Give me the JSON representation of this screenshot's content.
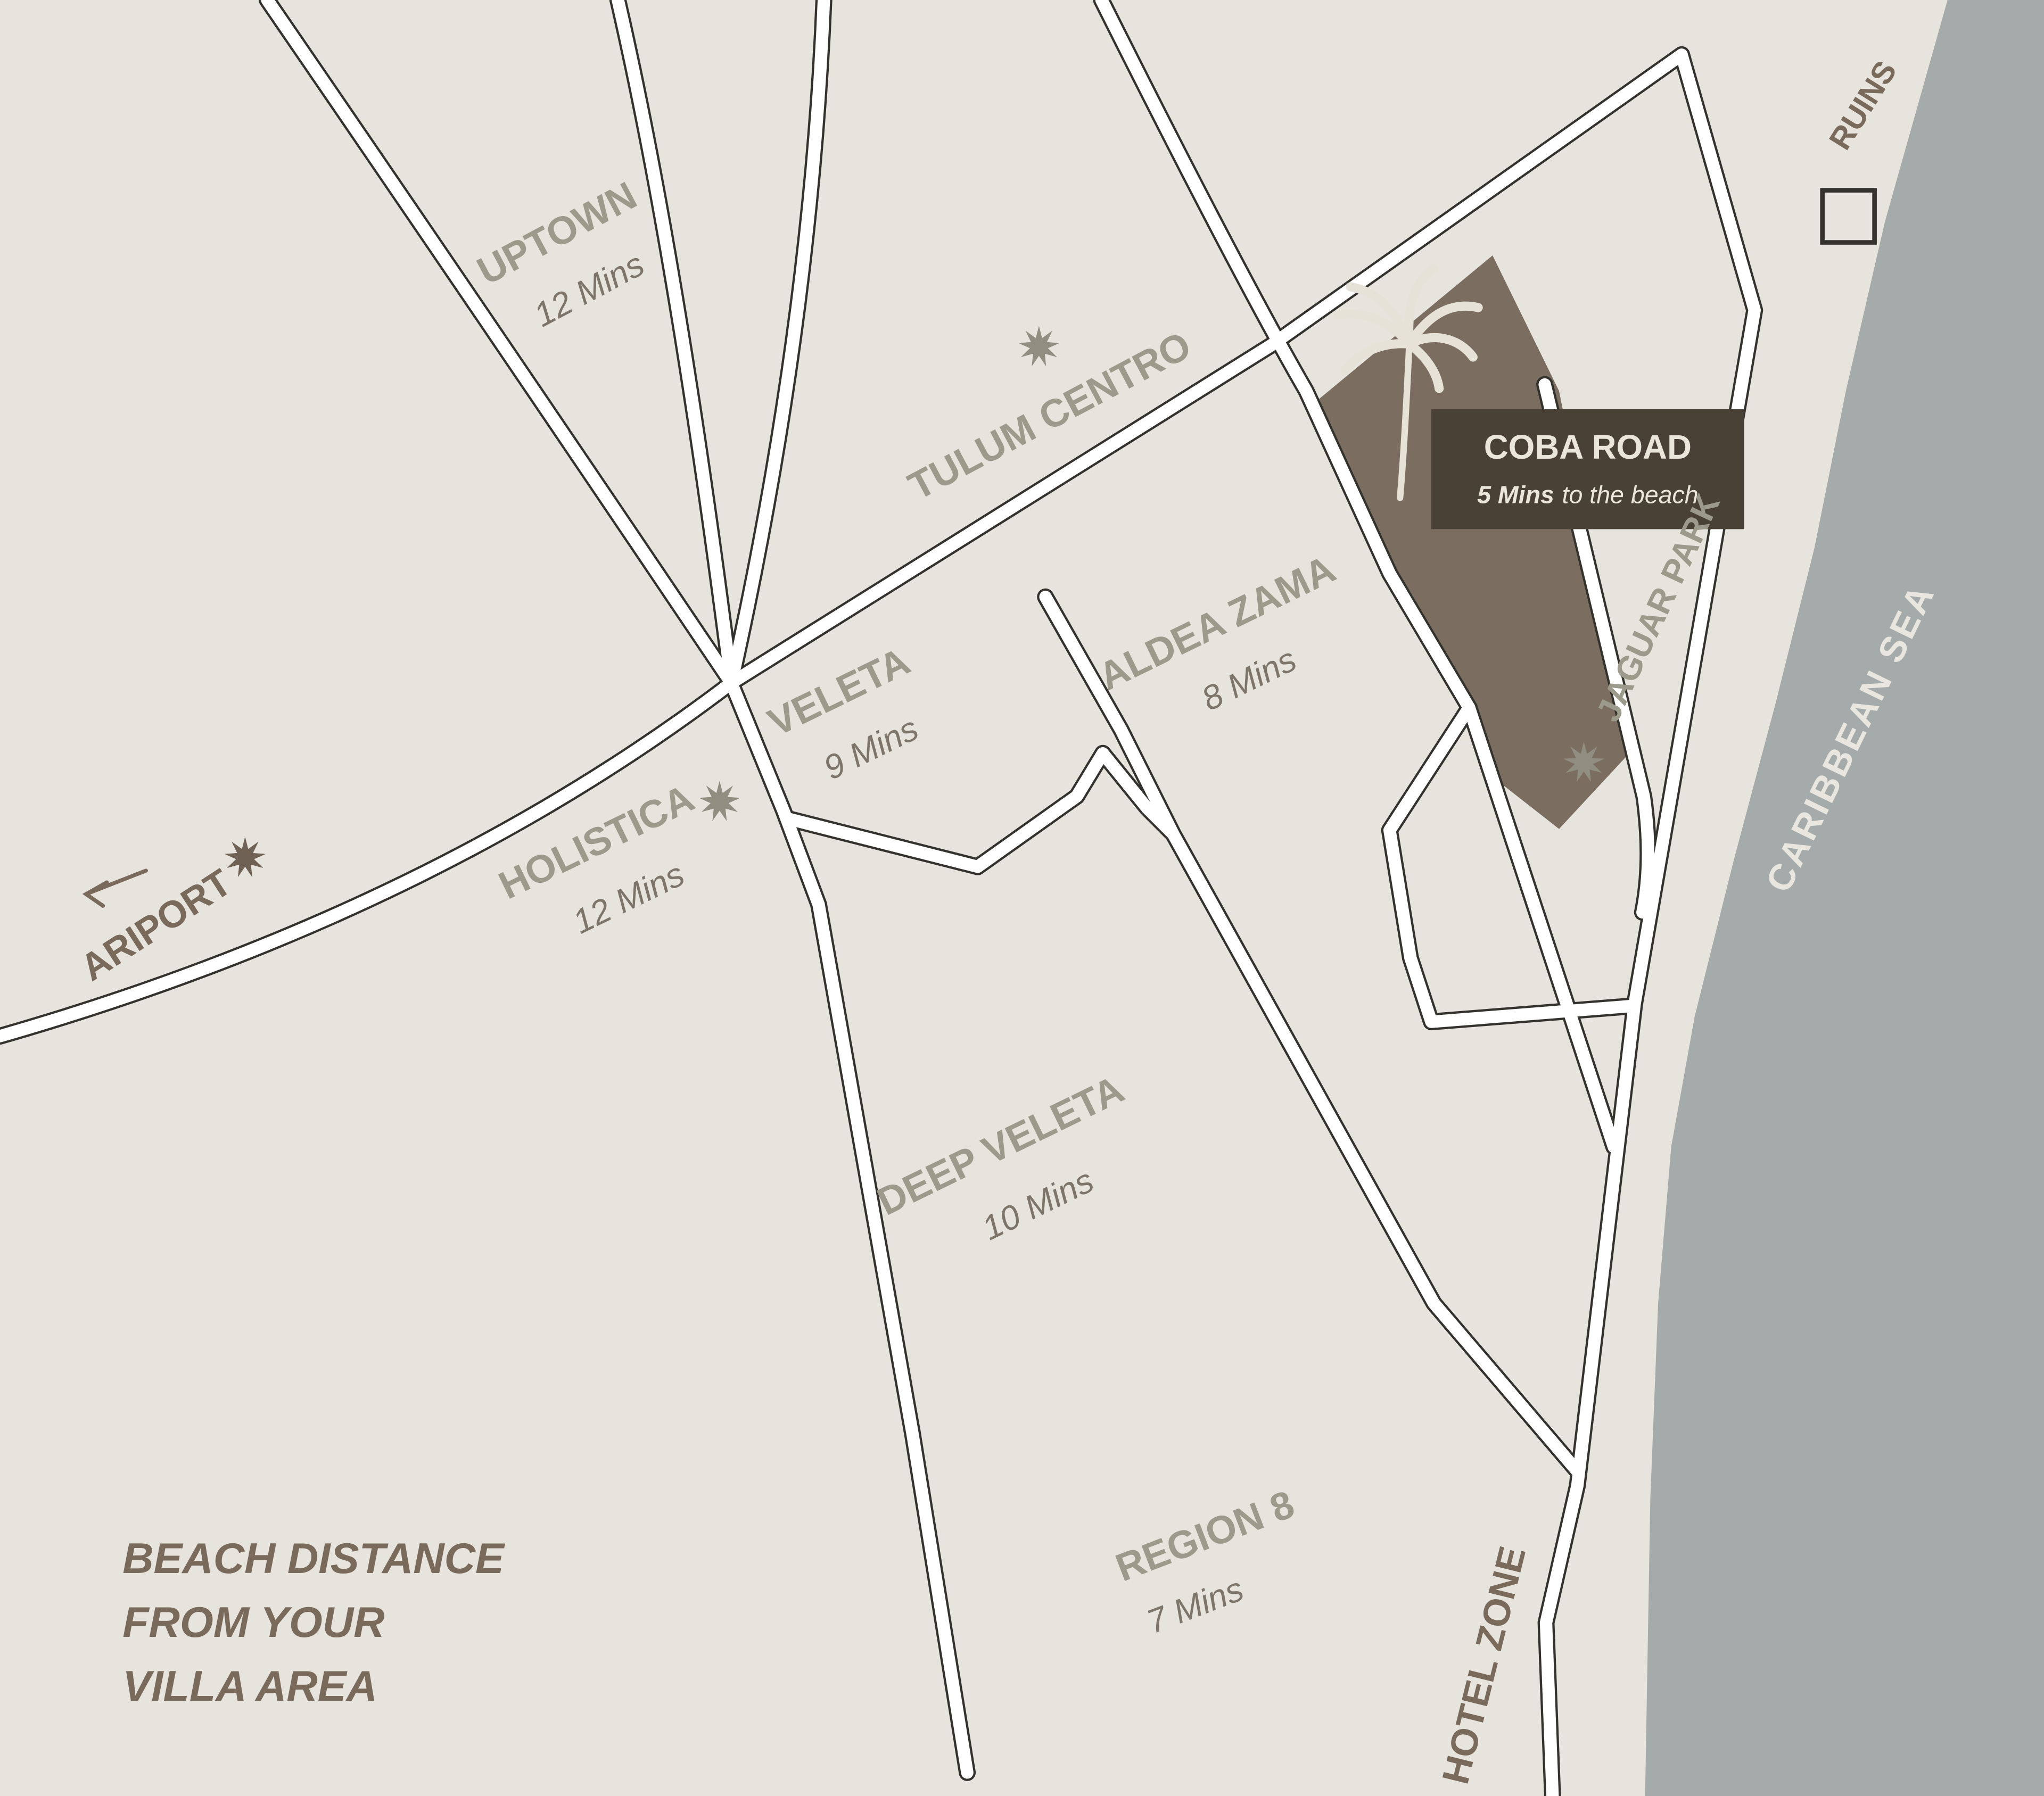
{
  "map_title": "Tulum villa beach-distance map",
  "areas": {
    "uptown": {
      "name": "UPTOWN",
      "time": "12 Mins"
    },
    "tulum_centro": {
      "name": "TULUM CENTRO"
    },
    "veleta": {
      "name": "VELETA",
      "time": "9 Mins"
    },
    "aldea_zama": {
      "name": "ALDEA ZAMA",
      "time": "8 Mins"
    },
    "holistica": {
      "name": "HOLISTICA",
      "time": "12 Mins"
    },
    "deep_veleta": {
      "name": "DEEP VELETA",
      "time": "10 Mins"
    },
    "region_8": {
      "name": "REGION 8",
      "time": "7 Mins"
    },
    "hotel_zone": {
      "name": "HOTEL ZONE"
    },
    "jaguar_park": {
      "name": "JAGUAR PARK"
    },
    "airport": {
      "name": "ARIPORT"
    },
    "ruins": {
      "name": "RUINS"
    },
    "sea": {
      "name": "CARIBBEAN SEA"
    }
  },
  "highlight": {
    "name": "COBA ROAD",
    "time_bold": "5 Mins",
    "time_rest": "to the beach"
  },
  "note": {
    "line1": "BEACH DISTANCE",
    "line2": "FROM YOUR",
    "line3": "VILLA AREA"
  },
  "icons": {
    "palm": "palm-tree-icon",
    "star": "starburst-icon",
    "arrow": "arrow-left-icon",
    "ruins_marker": "ruins-square-icon"
  },
  "colors": {
    "land": "#e7e4de",
    "sea": "#a4abaa",
    "road_fill": "#ffffff",
    "road_casing": "#33322d",
    "area_label": "#9b9a8b",
    "time_label": "#7d7569",
    "brown_label": "#7a6a5b",
    "villa_area": "#7b6e60",
    "badge_bg": "#4a4136",
    "badge_text": "#eae6dc",
    "star_gray": "#8f8e80",
    "star_brown": "#6f6154"
  }
}
